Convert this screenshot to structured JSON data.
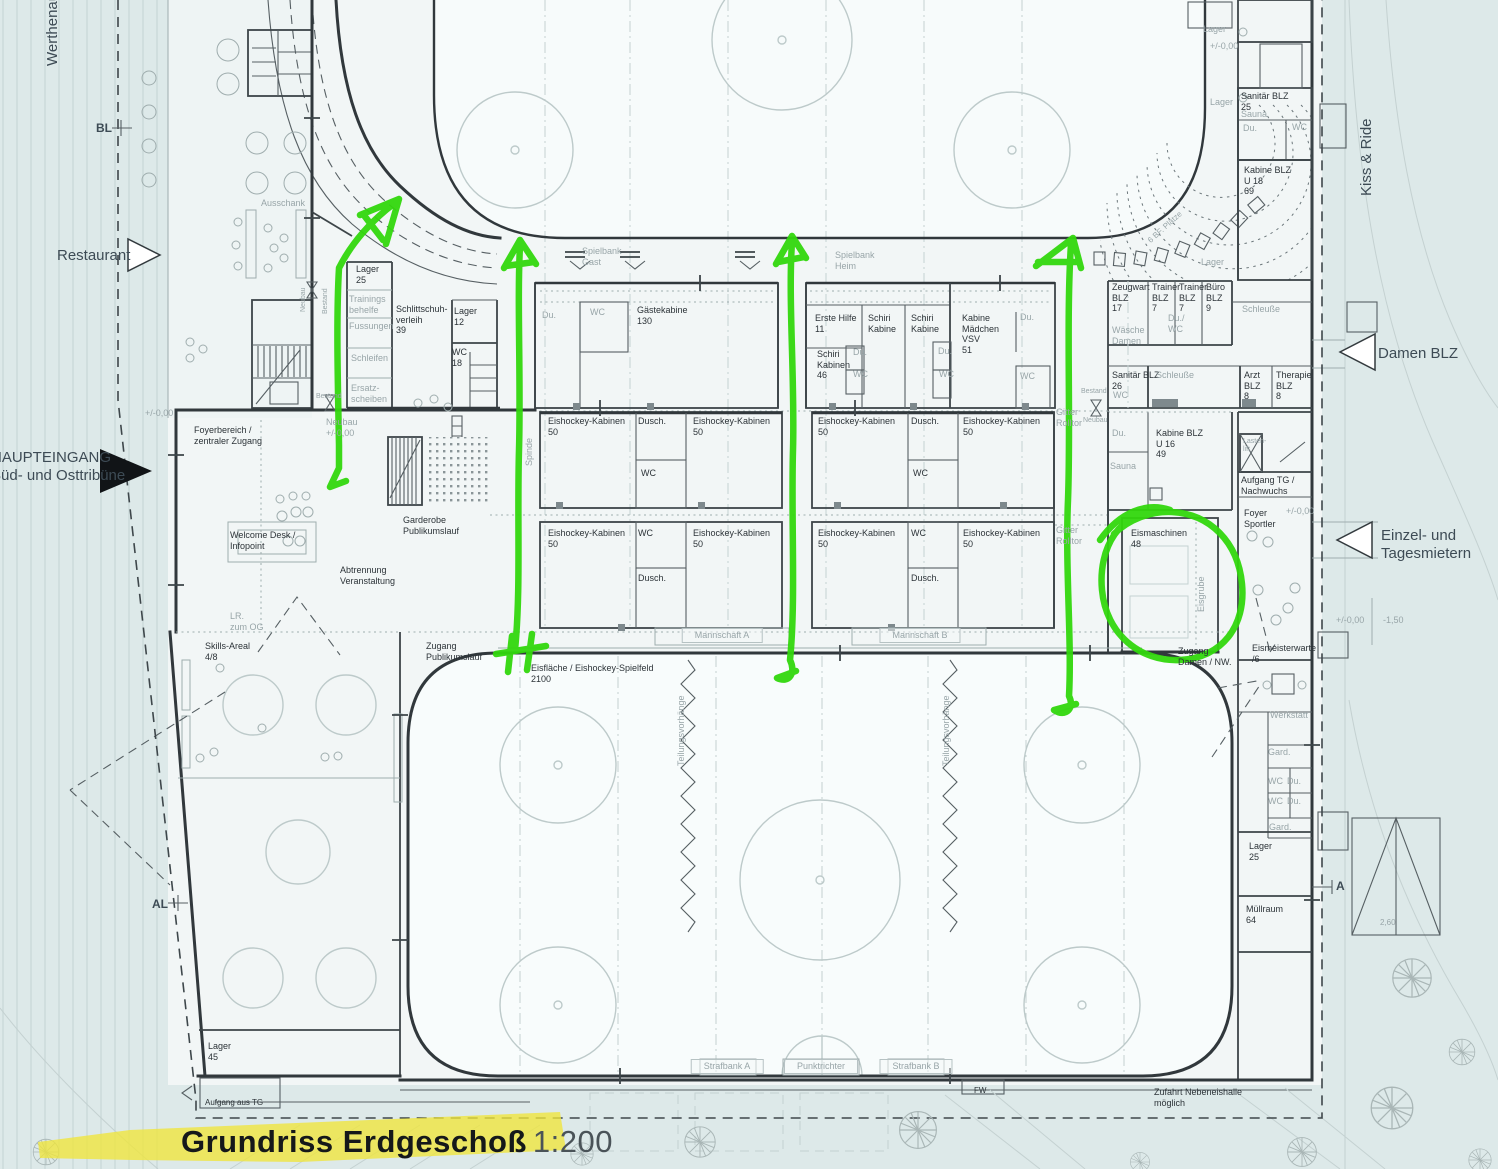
{
  "title": {
    "main": "Grundriss Erdgeschoß",
    "scale": "1:200"
  },
  "colors": {
    "annotation_green": "#32d70d",
    "highlight_yellow": "#f0e63b",
    "paper": "#f2f6f6",
    "site": "#dde9e9",
    "wall": "#31383c",
    "gray_text": "#98a5a8",
    "dark_text": "#2c3338",
    "edge_text": "#3d4b55"
  },
  "labels": [
    {
      "n": "werthenau-street",
      "t": "Werthenau",
      "x": 44,
      "y": 66,
      "c": "e",
      "r": -90
    },
    {
      "n": "kiss-ride-street",
      "t": "Kiss & Ride",
      "x": 1358,
      "y": 196,
      "c": "e",
      "r": -90
    },
    {
      "n": "restaurant-entrance",
      "t": "Restaurant",
      "x": 57,
      "y": 247,
      "c": "e"
    },
    {
      "n": "haupteingang",
      "t": "HAUPTEINGANG\nSüd- und Osttribüne",
      "x": -9,
      "y": 449,
      "c": "e"
    },
    {
      "n": "damen-blz-entrance",
      "t": "Damen BLZ",
      "x": 1378,
      "y": 345,
      "c": "e"
    },
    {
      "n": "einzel-tagesmieter-entrance",
      "t": "Einzel- und\nTagesmietern",
      "x": 1381,
      "y": 527,
      "c": "e"
    },
    {
      "n": "marker-bl",
      "t": "BL",
      "x": 96,
      "y": 121,
      "c": "e2"
    },
    {
      "n": "marker-al",
      "t": "AL",
      "x": 152,
      "y": 897,
      "c": "e2"
    },
    {
      "n": "marker-a",
      "t": "A",
      "x": 1336,
      "y": 879,
      "c": "e2"
    },
    {
      "n": "lager-25-top",
      "t": "Lager\n25",
      "x": 356,
      "y": 264
    },
    {
      "n": "schlittschuhverleih",
      "t": "Schlittschuh-\nverleih\n39",
      "x": 396,
      "y": 304
    },
    {
      "n": "lager-12",
      "t": "Lager\n12",
      "x": 454,
      "y": 306
    },
    {
      "n": "wc-18",
      "t": "WC\n18",
      "x": 452,
      "y": 347
    },
    {
      "n": "gaestekabine",
      "t": "Gästekabine\n130",
      "x": 637,
      "y": 305
    },
    {
      "n": "erste-hilfe",
      "t": "Erste Hilfe\n11",
      "x": 815,
      "y": 313
    },
    {
      "n": "schiri-kabine-1",
      "t": "Schiri\nKabine",
      "x": 868,
      "y": 313
    },
    {
      "n": "schiri-kabine-2",
      "t": "Schiri\nKabine",
      "x": 911,
      "y": 313
    },
    {
      "n": "kabine-maedchen",
      "t": "Kabine\nMädchen\nVSV\n51",
      "x": 962,
      "y": 313
    },
    {
      "n": "schiri-kabinen-46",
      "t": "Schiri\nKabinen\n46",
      "x": 817,
      "y": 349
    },
    {
      "n": "zeugwart-blz",
      "t": "Zeugwart\nBLZ\n17",
      "x": 1112,
      "y": 282
    },
    {
      "n": "trainer-blz-1",
      "t": "Trainer\nBLZ\n7",
      "x": 1152,
      "y": 282
    },
    {
      "n": "trainer-blz-2",
      "t": "Trainer\nBLZ\n7",
      "x": 1179,
      "y": 282
    },
    {
      "n": "buero-blz",
      "t": "Büro\nBLZ\n9",
      "x": 1206,
      "y": 282
    },
    {
      "n": "sanitaer-blz-26",
      "t": "Sanitär BLZ\n26",
      "x": 1112,
      "y": 370
    },
    {
      "n": "arzt-blz",
      "t": "Arzt\nBLZ\n8",
      "x": 1244,
      "y": 370
    },
    {
      "n": "therapie-blz",
      "t": "Therapie\nBLZ\n8",
      "x": 1276,
      "y": 370
    },
    {
      "n": "sanitaer-blz-25",
      "t": "Sanitär BLZ\n25",
      "x": 1241,
      "y": 91
    },
    {
      "n": "kabine-blz-u18",
      "t": "Kabine BLZ\nU 18\n69",
      "x": 1244,
      "y": 165
    },
    {
      "n": "eishockey-kabine-1",
      "t": "Eishockey-Kabinen\n50",
      "x": 548,
      "y": 416
    },
    {
      "n": "dusch-1",
      "t": "Dusch.",
      "x": 638,
      "y": 416
    },
    {
      "n": "eishockey-kabine-2",
      "t": "Eishockey-Kabinen\n50",
      "x": 693,
      "y": 416
    },
    {
      "n": "wc-mid-1",
      "t": "WC",
      "x": 641,
      "y": 468
    },
    {
      "n": "eishockey-kabine-3",
      "t": "Eishockey-Kabinen\n50",
      "x": 548,
      "y": 528
    },
    {
      "n": "wc-mid-2",
      "t": "WC",
      "x": 638,
      "y": 528
    },
    {
      "n": "eishockey-kabine-4",
      "t": "Eishockey-Kabinen\n50",
      "x": 693,
      "y": 528
    },
    {
      "n": "dusch-2",
      "t": "Dusch.",
      "x": 638,
      "y": 573
    },
    {
      "n": "eishockey-kabine-5",
      "t": "Eishockey-Kabinen\n50",
      "x": 818,
      "y": 416
    },
    {
      "n": "dusch-3",
      "t": "Dusch.",
      "x": 911,
      "y": 416
    },
    {
      "n": "eishockey-kabine-6",
      "t": "Eishockey-Kabinen\n50",
      "x": 963,
      "y": 416
    },
    {
      "n": "wc-mid-3",
      "t": "WC",
      "x": 913,
      "y": 468
    },
    {
      "n": "eishockey-kabine-7",
      "t": "Eishockey-Kabinen\n50",
      "x": 818,
      "y": 528
    },
    {
      "n": "wc-mid-4",
      "t": "WC",
      "x": 911,
      "y": 528
    },
    {
      "n": "eishockey-kabine-8",
      "t": "Eishockey-Kabinen\n50",
      "x": 963,
      "y": 528
    },
    {
      "n": "dusch-4",
      "t": "Dusch.",
      "x": 911,
      "y": 573
    },
    {
      "n": "kabine-blz-u16",
      "t": "Kabine BLZ\nU 16\n49",
      "x": 1156,
      "y": 428
    },
    {
      "n": "aufgang-tg",
      "t": "Aufgang TG /\nNachwuchs",
      "x": 1241,
      "y": 475
    },
    {
      "n": "foyer-sportler",
      "t": "Foyer\nSportler",
      "x": 1244,
      "y": 508
    },
    {
      "n": "eismaschinen",
      "t": "Eismaschinen\n48",
      "x": 1131,
      "y": 528
    },
    {
      "n": "foyerbereich",
      "t": "Foyerbereich /\nzentraler Zugang",
      "x": 194,
      "y": 425
    },
    {
      "n": "welcome-desk",
      "t": "Welcome Desk /\nInfopoint",
      "x": 230,
      "y": 530
    },
    {
      "n": "abtrennung",
      "t": "Abtrennung\nVeranstaltung",
      "x": 340,
      "y": 565
    },
    {
      "n": "garderobe",
      "t": "Garderobe\nPublikumslauf",
      "x": 403,
      "y": 515
    },
    {
      "n": "zugang-publikumslauf",
      "t": "Zugang\nPublikumslauf",
      "x": 426,
      "y": 641
    },
    {
      "n": "eisflaeche",
      "t": "Eisfläche / Eishockey-Spielfeld\n2100",
      "x": 531,
      "y": 663
    },
    {
      "n": "zugang-damen-nw",
      "t": "Zugang\nDamen / NW.",
      "x": 1178,
      "y": 646
    },
    {
      "n": "eismeisterwarte",
      "t": "Eismeisterwarte\n/6",
      "x": 1252,
      "y": 643
    },
    {
      "n": "lager-25-bottom",
      "t": "Lager\n25",
      "x": 1249,
      "y": 841
    },
    {
      "n": "muellraum",
      "t": "Müllraum\n64",
      "x": 1246,
      "y": 904
    },
    {
      "n": "skills-areal",
      "t": "Skills-Areal\n4/8",
      "x": 205,
      "y": 641
    },
    {
      "n": "lager-45",
      "t": "Lager\n45",
      "x": 208,
      "y": 1041
    },
    {
      "n": "aufgang-aus-tg",
      "t": "Aufgang aus TG",
      "x": 205,
      "y": 1098,
      "s": 8
    },
    {
      "n": "zufahrt-nebeneishalle",
      "t": "Zufahrt Nebeneishalle\nmöglich",
      "x": 1198,
      "y": 1087,
      "a": "c"
    },
    {
      "n": "fw-door",
      "t": "FW",
      "x": 974,
      "y": 1086,
      "s": 8
    },
    {
      "n": "ausschank",
      "t": "Ausschank",
      "x": 261,
      "y": 198,
      "c": "g"
    },
    {
      "n": "spielbank-gast",
      "t": "Spielbank\nGast",
      "x": 582,
      "y": 246,
      "c": "g"
    },
    {
      "n": "spielbank-heim",
      "t": "Spielbank\nHeim",
      "x": 835,
      "y": 250,
      "c": "g"
    },
    {
      "n": "trainingsbehelfe",
      "t": "Trainings\nbehelfe",
      "x": 349,
      "y": 294,
      "c": "g"
    },
    {
      "n": "fussungen",
      "t": "Fussungen",
      "x": 349,
      "y": 321,
      "c": "g"
    },
    {
      "n": "schleifen",
      "t": "Schleifen",
      "x": 351,
      "y": 353,
      "c": "g"
    },
    {
      "n": "ersatzscheiben",
      "t": "Ersatz-\nscheiben",
      "x": 351,
      "y": 383,
      "c": "g"
    },
    {
      "n": "du-1",
      "t": "Du.",
      "x": 542,
      "y": 310,
      "c": "g"
    },
    {
      "n": "wc-1",
      "t": "WC",
      "x": 590,
      "y": 307,
      "c": "g"
    },
    {
      "n": "du-2",
      "t": "Du.",
      "x": 853,
      "y": 347,
      "c": "g"
    },
    {
      "n": "wc-2",
      "t": "WC",
      "x": 853,
      "y": 369,
      "c": "g"
    },
    {
      "n": "du-3",
      "t": "Du.",
      "x": 938,
      "y": 346,
      "c": "g"
    },
    {
      "n": "wc-3",
      "t": "WC",
      "x": 939,
      "y": 369,
      "c": "g"
    },
    {
      "n": "du-4",
      "t": "Du.",
      "x": 1020,
      "y": 312,
      "c": "g"
    },
    {
      "n": "wc-4",
      "t": "WC",
      "x": 1020,
      "y": 371,
      "c": "g"
    },
    {
      "n": "schleusse-1",
      "t": "Schleuße",
      "x": 1242,
      "y": 304,
      "c": "g"
    },
    {
      "n": "du-wc",
      "t": "Du./\nWC",
      "x": 1168,
      "y": 313,
      "c": "g"
    },
    {
      "n": "waesche-damen",
      "t": "Wäsche\nDamen",
      "x": 1112,
      "y": 325,
      "c": "g"
    },
    {
      "n": "wc-5",
      "t": "WC",
      "x": 1113,
      "y": 390,
      "c": "g"
    },
    {
      "n": "schleusse-2",
      "t": "Schleuße",
      "x": 1156,
      "y": 370,
      "c": "g"
    },
    {
      "n": "sauna-1",
      "t": "Sauna",
      "x": 1241,
      "y": 109,
      "c": "g"
    },
    {
      "n": "du-5",
      "t": "Du.",
      "x": 1243,
      "y": 123,
      "c": "g"
    },
    {
      "n": "wc-6",
      "t": "WC",
      "x": 1292,
      "y": 122,
      "c": "g"
    },
    {
      "n": "lager-top-1",
      "t": "Lager",
      "x": 1203,
      "y": 24,
      "c": "g"
    },
    {
      "n": "lager-top-2",
      "t": "Lager",
      "x": 1210,
      "y": 97,
      "c": "g"
    },
    {
      "n": "lager-tribune",
      "t": "Lager",
      "x": 1201,
      "y": 257,
      "c": "g"
    },
    {
      "n": "du-6",
      "t": "Du.",
      "x": 1112,
      "y": 428,
      "c": "g"
    },
    {
      "n": "sauna-2",
      "t": "Sauna",
      "x": 1110,
      "y": 461,
      "c": "g"
    },
    {
      "n": "lastenlift",
      "t": "Lasten-\nlift",
      "x": 1243,
      "y": 438,
      "c": "g",
      "s": 7
    },
    {
      "n": "gitter-rolltor-1",
      "t": "Gitter\nRolltor",
      "x": 1056,
      "y": 407,
      "c": "g"
    },
    {
      "n": "gitter-rolltor-2",
      "t": "Gitter\nRolltor",
      "x": 1056,
      "y": 525,
      "c": "g"
    },
    {
      "n": "werkstatt",
      "t": "Werkstatt",
      "x": 1270,
      "y": 710,
      "c": "g"
    },
    {
      "n": "gard-1",
      "t": "Gard.",
      "x": 1268,
      "y": 747,
      "c": "g"
    },
    {
      "n": "wc-7",
      "t": "WC",
      "x": 1268,
      "y": 776,
      "c": "g"
    },
    {
      "n": "du-7",
      "t": "Du.",
      "x": 1287,
      "y": 776,
      "c": "g"
    },
    {
      "n": "wc-8",
      "t": "WC",
      "x": 1268,
      "y": 796,
      "c": "g"
    },
    {
      "n": "du-8",
      "t": "Du.",
      "x": 1287,
      "y": 796,
      "c": "g"
    },
    {
      "n": "gard-2",
      "t": "Gard.",
      "x": 1269,
      "y": 822,
      "c": "g"
    },
    {
      "n": "neubau-v",
      "t": "Neubau",
      "x": 300,
      "y": 312,
      "c": "g",
      "r": -90,
      "s": 7
    },
    {
      "n": "bestand-v",
      "t": "Bestand",
      "x": 322,
      "y": 314,
      "c": "g",
      "r": -90,
      "s": 7
    },
    {
      "n": "bestand-h",
      "t": "Bestand",
      "x": 1081,
      "y": 388,
      "c": "g",
      "s": 7
    },
    {
      "n": "neubau-h",
      "t": "Neubau",
      "x": 1083,
      "y": 417,
      "c": "g",
      "s": 7
    },
    {
      "n": "bestand-b",
      "t": "Bestand",
      "x": 316,
      "y": 393,
      "c": "g",
      "s": 7
    },
    {
      "n": "elev-terrasse",
      "t": "+/-0,00",
      "x": 145,
      "y": 408,
      "c": "g"
    },
    {
      "n": "neubau-elev",
      "t": "Neubau\n+/-0,00",
      "x": 326,
      "y": 417,
      "c": "g"
    },
    {
      "n": "elev-top-right",
      "t": "+/-0,00",
      "x": 1210,
      "y": 41,
      "c": "g"
    },
    {
      "n": "elev-foyer-sportler",
      "t": "+/-0,00",
      "x": 1286,
      "y": 506,
      "c": "g"
    },
    {
      "n": "elev-einzel",
      "t": "+/-0,00",
      "x": 1336,
      "y": 615,
      "c": "g"
    },
    {
      "n": "elev-minus150",
      "t": "-1,50",
      "x": 1383,
      "y": 615,
      "c": "g"
    },
    {
      "n": "bf-plaetze",
      "t": "6 BF. Plätze",
      "x": 1146,
      "y": 238,
      "c": "g",
      "r": -42,
      "s": 8
    },
    {
      "n": "lr-zum-og",
      "t": "LR.\nzum OG",
      "x": 230,
      "y": 611,
      "c": "g"
    },
    {
      "n": "spinde",
      "t": "Spinde",
      "x": 524,
      "y": 466,
      "c": "g",
      "r": -90
    },
    {
      "n": "eisgrube",
      "t": "Eisgrube",
      "x": 1196,
      "y": 612,
      "c": "g",
      "r": -90
    },
    {
      "n": "teilungsvorhaenge-1",
      "t": "Teilungsvorhänge",
      "x": 676,
      "y": 766,
      "c": "g",
      "r": -90
    },
    {
      "n": "teilungsvorhaenge-2",
      "t": "Teilungsvorhänge",
      "x": 941,
      "y": 766,
      "c": "g",
      "r": -90
    },
    {
      "n": "masz-260",
      "t": "2,60",
      "x": 1380,
      "y": 918,
      "c": "g",
      "s": 8
    },
    {
      "n": "mannschaft-a",
      "t": "Mannschaft A",
      "x": 722,
      "y": 628,
      "c": "box",
      "a": "c"
    },
    {
      "n": "mannschaft-b",
      "t": "Mannschaft B",
      "x": 920,
      "y": 628,
      "c": "box",
      "a": "c"
    },
    {
      "n": "strafbank-a",
      "t": "Strafbank A",
      "x": 727,
      "y": 1059,
      "c": "box",
      "a": "c"
    },
    {
      "n": "punktrichter",
      "t": "Punktrichter",
      "x": 821,
      "y": 1059,
      "c": "box",
      "a": "c"
    },
    {
      "n": "strafbank-b",
      "t": "Strafbank B",
      "x": 916,
      "y": 1059,
      "c": "box",
      "a": "c"
    }
  ]
}
